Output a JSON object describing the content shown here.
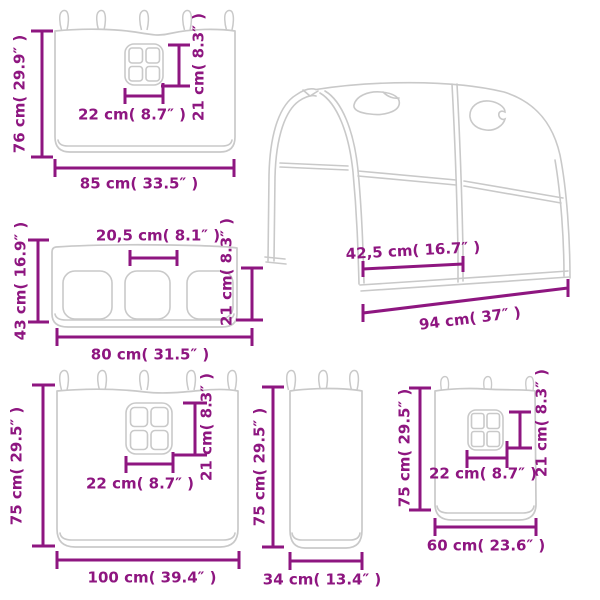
{
  "colors": {
    "dimension_text": "#8e1680",
    "product_outline": "#c9c9c9",
    "background": "#ffffff"
  },
  "diagram": {
    "type": "product-dimension-diagram",
    "panels": [
      {
        "id": "curtain-85x76",
        "labels": {
          "height": "76 cm( 29.9″ )",
          "width": "85 cm( 33.5″ )",
          "window_width": "22 cm( 8.7″ )",
          "window_height": "21 cm( 8.3″ )"
        }
      },
      {
        "id": "tunnel-94",
        "labels": {
          "opening_width": "42,5 cm( 16.7″ )",
          "length": "94 cm( 37″ )"
        }
      },
      {
        "id": "panel-80x43",
        "labels": {
          "height": "43 cm( 16.9″ )",
          "width": "80 cm( 31.5″ )",
          "window_width": "20,5 cm( 8.1″ )",
          "window_height": "21 cm( 8.3″ )"
        }
      },
      {
        "id": "curtain-100x75",
        "labels": {
          "height": "75 cm( 29.5″ )",
          "width": "100 cm( 39.4″ )",
          "window_width": "22 cm( 8.7″ )",
          "window_height": "21 cm( 8.3″ )"
        }
      },
      {
        "id": "panel-34x75",
        "labels": {
          "height": "75 cm( 29.5″ )",
          "width": "34 cm( 13.4″ )"
        }
      },
      {
        "id": "curtain-60x75",
        "labels": {
          "height": "75 cm( 29.5″ )",
          "width": "60 cm( 23.6″ )",
          "window_width": "22 cm( 8.7″ )",
          "window_height": "21 cm( 8.3″ )"
        }
      }
    ]
  }
}
